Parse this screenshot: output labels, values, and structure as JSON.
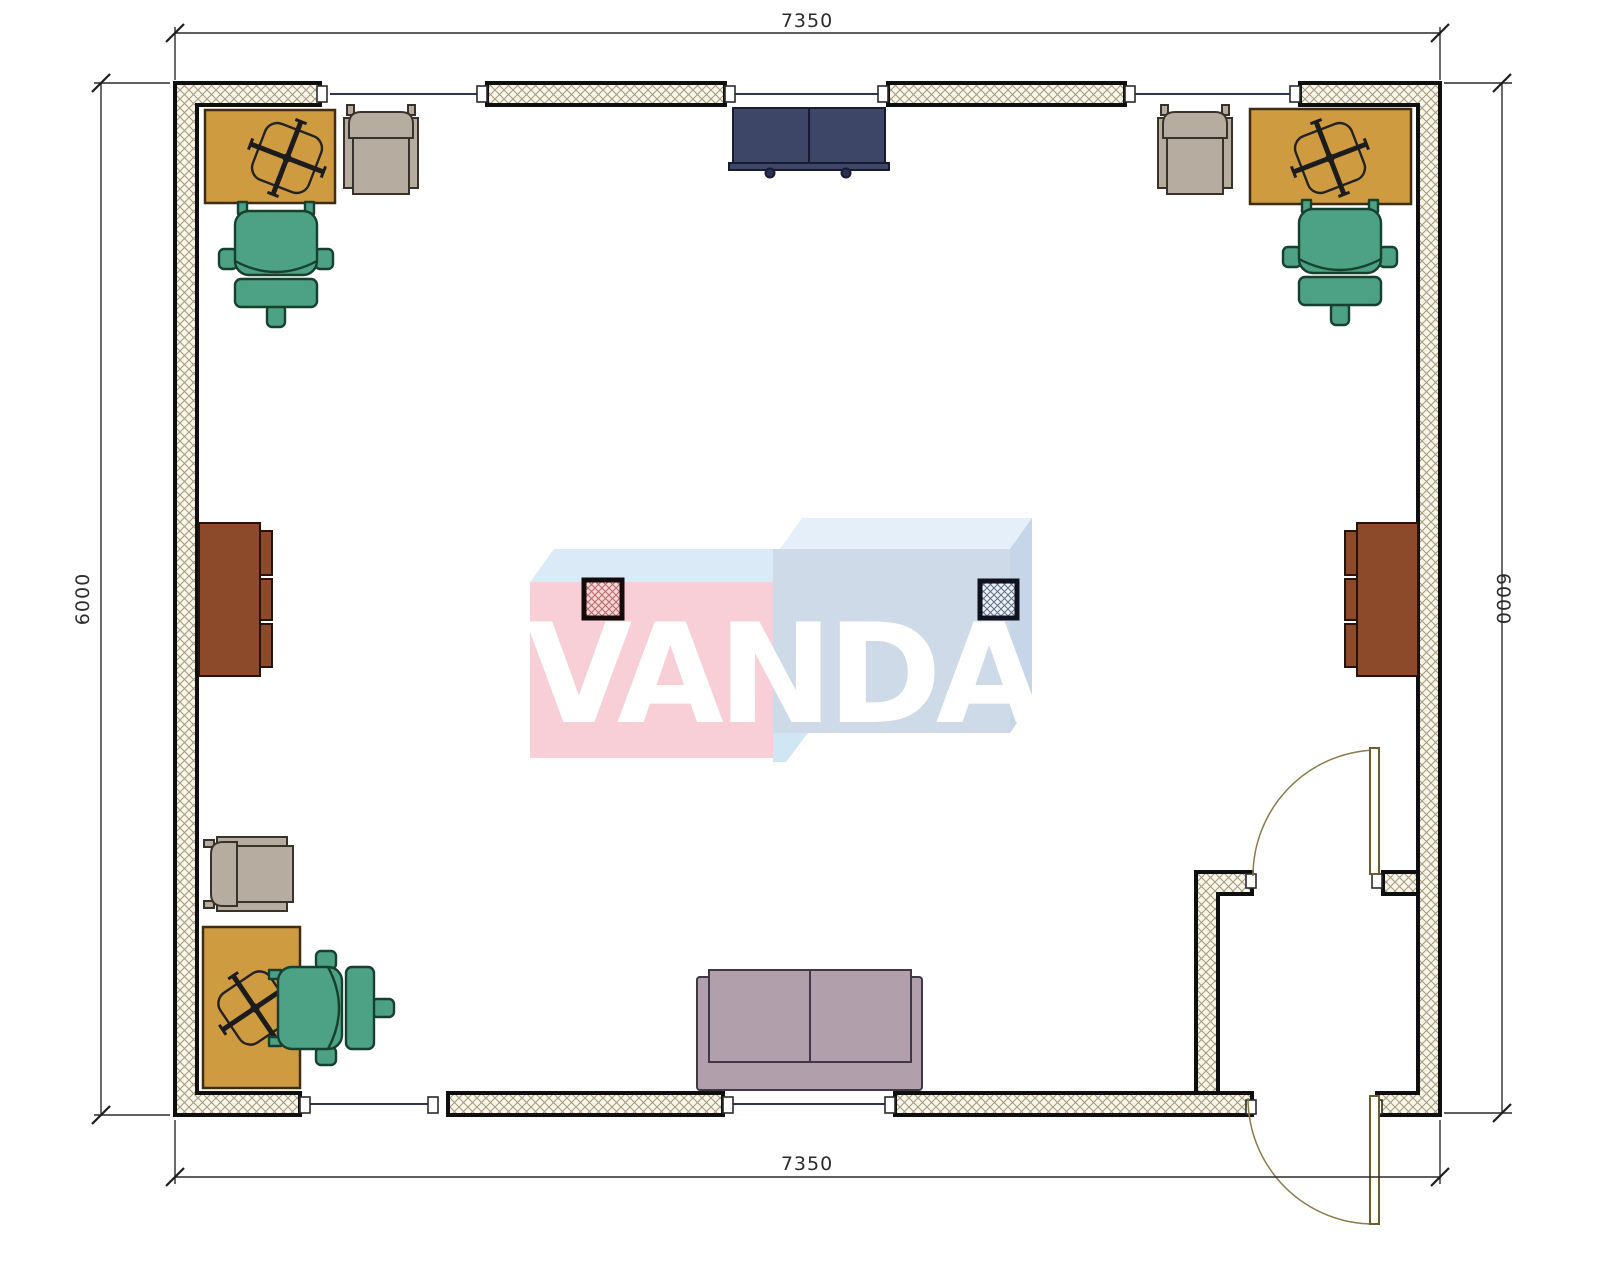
{
  "drawing": {
    "type": "office floor plan",
    "dimensions": {
      "top": "7350",
      "bottom": "7350",
      "left": "6000",
      "right": "6000"
    },
    "watermark": {
      "text": "VANDA"
    },
    "colors": {
      "desk": "#cf9b41",
      "chair_green": "#4da184",
      "chair_beige": "#b7aca0",
      "cabinet_brown": "#8d4a2a",
      "credenza_navy": "#3e4668",
      "credenza_knob": "#2c3150",
      "sofa_mauve": "#b1a0ac",
      "wall_outline": "#0f0f0f",
      "window_line": "#2e3657",
      "door_swing": "#8a7a4a",
      "column_pink_fill": "#f6d7d7",
      "column_blue_fill": "#eef1f5",
      "watermark_pink": "#f8ccd5",
      "watermark_blue_front": "#cdd9e8",
      "watermark_blue_top_left": "#d9eaf7",
      "watermark_blue_top_right": "#e3eff9",
      "watermark_blue_side": "#c3d3e6",
      "watermark_notch": "#cfe5f5"
    }
  }
}
